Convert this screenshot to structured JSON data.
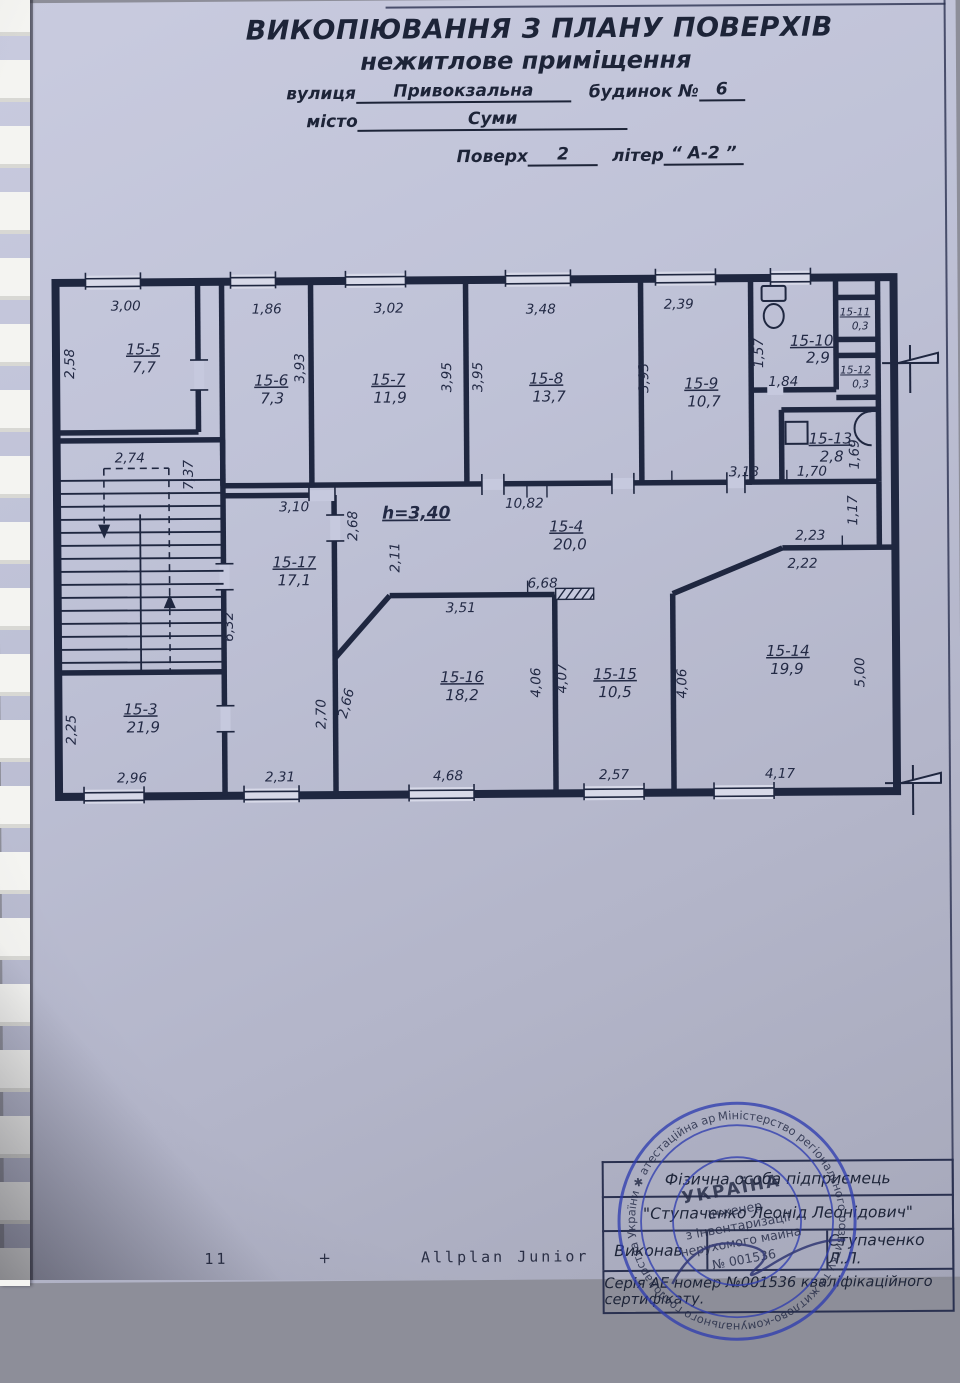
{
  "title": {
    "line1": "ВИКОПІЮВАННЯ З ПЛАНУ ПОВЕРХІВ",
    "line2": "нежитлове приміщення",
    "street_label": "вулиця",
    "street_value": "Привокзальна",
    "house_label": "будинок №",
    "house_value": "6",
    "city_label": "місто",
    "city_value": "Суми",
    "floor_label": "Поверх",
    "floor_value": "2",
    "liter_label": "літер",
    "liter_value": "“ А-2 ”"
  },
  "plan": {
    "height_note": "h=3,40",
    "rooms": [
      {
        "label": "15-5",
        "area": "7,7"
      },
      {
        "label": "15-6",
        "area": "7,3"
      },
      {
        "label": "15-7",
        "area": "11,9"
      },
      {
        "label": "15-8",
        "area": "13,7"
      },
      {
        "label": "15-9",
        "area": "10,7"
      },
      {
        "label": "15-10",
        "area": "2,9"
      },
      {
        "label": "15-11",
        "area": "0,3"
      },
      {
        "label": "15-12",
        "area": "0,3"
      },
      {
        "label": "15-13",
        "area": "2,8"
      },
      {
        "label": "15-4",
        "area": "20,0"
      },
      {
        "label": "15-17",
        "area": "17,1"
      },
      {
        "label": "15-16",
        "area": "18,2"
      },
      {
        "label": "15-15",
        "area": "10,5"
      },
      {
        "label": "15-14",
        "area": "19,9"
      },
      {
        "label": "15-3",
        "area": "21,9"
      }
    ],
    "dims": [
      "3,00",
      "2,58",
      "1,86",
      "3,93",
      "3,02",
      "3,95",
      "3,95",
      "3,48",
      "3,93",
      "2,39",
      "1,57",
      "1,84",
      "1,69",
      "3,18",
      "1,70",
      "1,17",
      "2,74",
      "7,37",
      "3,10",
      "2,68",
      "10,82",
      "2,11",
      "2,23",
      "2,22",
      "6,68",
      "3,51",
      "6,32",
      "2,70",
      "2,66",
      "4,06",
      "4,07",
      "4,06",
      "5,00",
      "2,25",
      "2,96",
      "2,31",
      "4,68",
      "2,57",
      "4,17"
    ]
  },
  "stamp_block": {
    "row1": "Фізична особа підприємець",
    "row2": "\"Ступаченко Леонід Леонідович\"",
    "executed_label": "Виконав",
    "executed_by": "Ступаченко Л.Л.",
    "series": "Серія АЕ номер №001536 кваліфікаційного сертифікату."
  },
  "stamp": {
    "ring": "Міністерство регіонального розвитку та житлово-комунального господарства України ✱ атестаційна архітектурно-будівельна комісія ✱",
    "country": "УКРАЇНА",
    "center1": "Інженер",
    "center2": "з інвентаризації",
    "center3": "нерухомого майна",
    "center4": "№ 001536"
  },
  "footer": {
    "page": "11",
    "plus": "+",
    "software": "Allplan Junior"
  }
}
